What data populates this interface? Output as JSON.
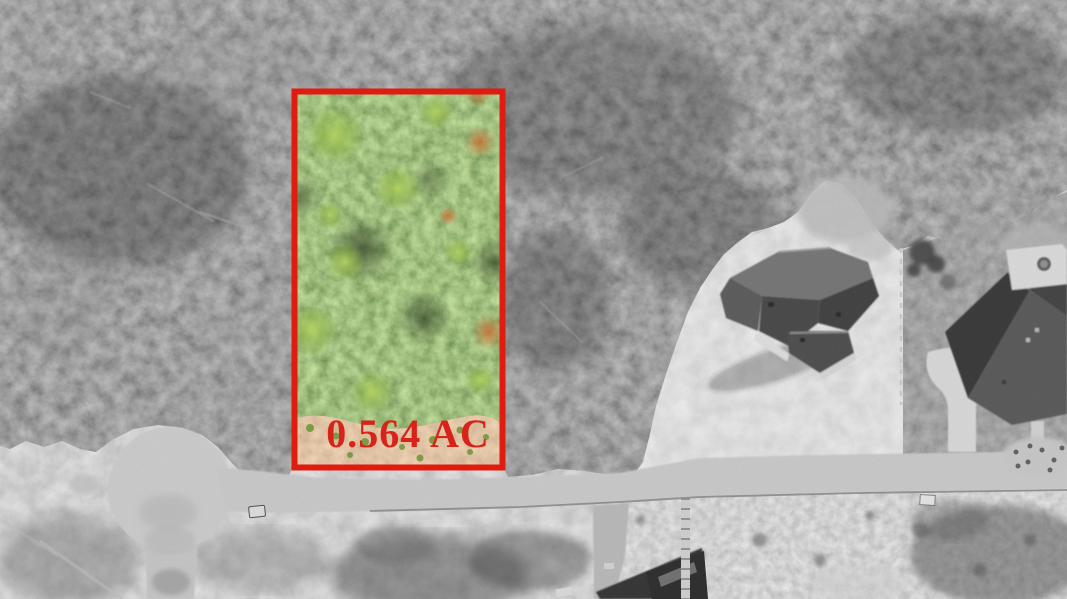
{
  "photo": {
    "type": "aerial-drone-real-estate-photo",
    "style": "surroundings desaturated to black-and-white; advertised lot shown in full color inside red outline",
    "width_px": 1067,
    "height_px": 599
  },
  "lot_highlight": {
    "label": "0.564 AC",
    "outline_color": "#e01b10",
    "label_color": "#d8231a"
  },
  "scene": {
    "features": [
      "dense wooded area covering upper portion",
      "highlighted tree-covered lot inside red outline",
      "cleared tan dirt strip at bottom of highlighted lot",
      "cul-de-sac street at lower left",
      "street running across lower portion to the right",
      "new street stub heading down from cul-de-sac",
      "house under construction on cleared dirt at center right",
      "finished house with driveway and patio at far right",
      "house under construction at bottom center with plank walkway"
    ]
  },
  "palette": {
    "forest_gray": "#4f4f4f",
    "cleared_dirt_gray": "#c2c2c2",
    "street_gray": "#c6c6c6",
    "lawn_gray": "#4e4e4e",
    "lot_canopy_green": "#578c2b",
    "lot_dirt_tan": "#c49a66",
    "annotation_red": "#e01b10"
  }
}
